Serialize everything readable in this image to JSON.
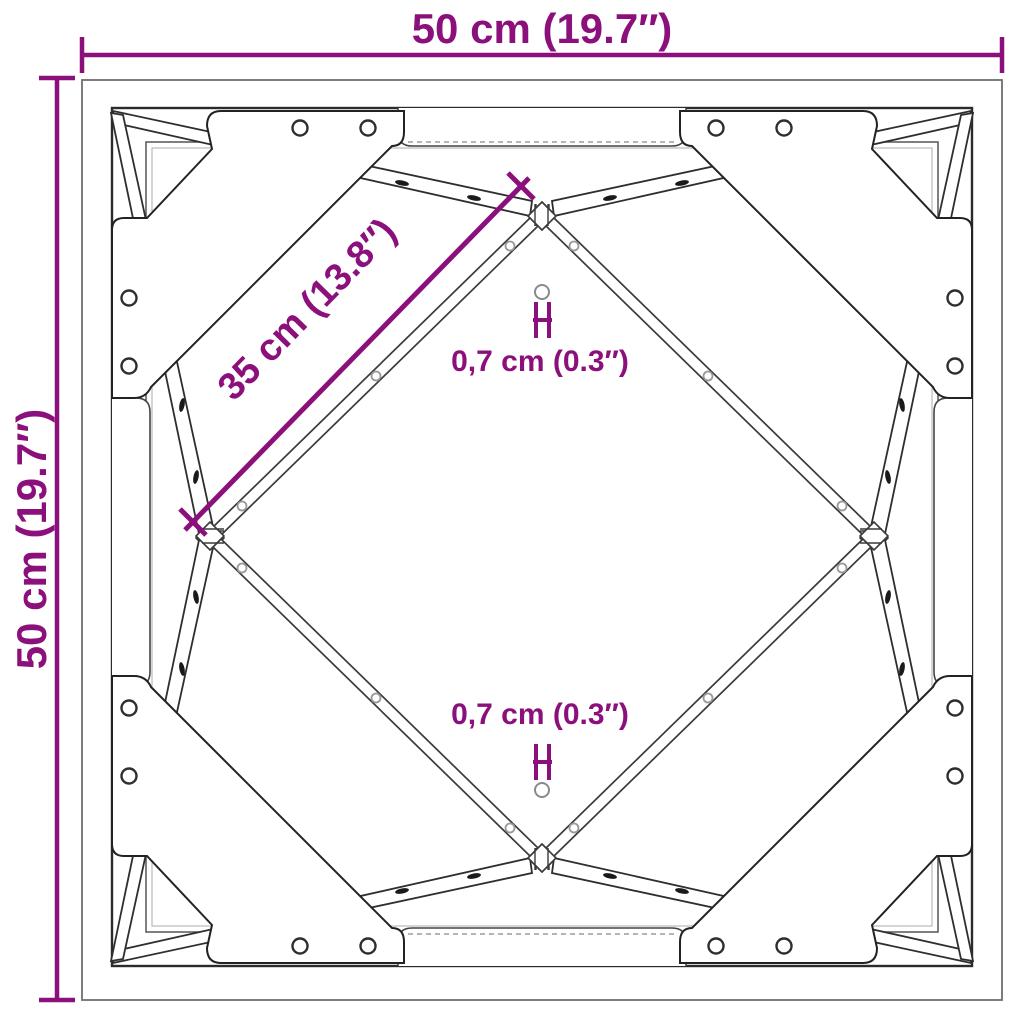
{
  "title": "Square frame top-view dimension diagram",
  "colors": {
    "dimension_accent": "#8b107b",
    "structure_line": "#2e2e2e",
    "structure_light": "#8a8a8a",
    "outer_border": "#6f6f6f",
    "background": "#ffffff"
  },
  "dimensions": {
    "top_width_label": "50 cm (19.7″)",
    "left_height_label": "50 cm (19.7″)",
    "diagonal_brace_label": "35 cm (13.8″)",
    "hole_top_label": "0,7 cm (0.3″)",
    "hole_bottom_label": "0,7 cm (0.3″)"
  }
}
